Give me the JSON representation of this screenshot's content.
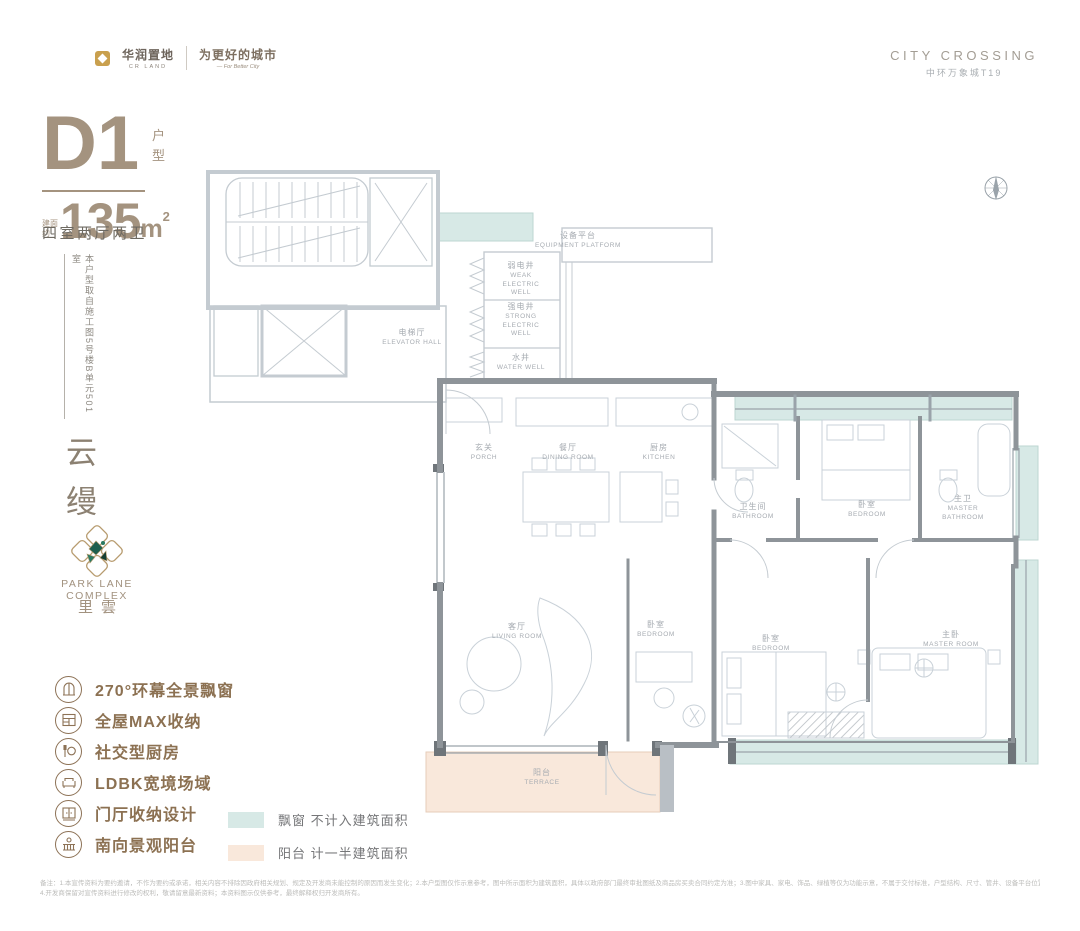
{
  "brand": {
    "logo_cn": "华润置地",
    "logo_en": "CR LAND",
    "tagline_cn": "为更好的城市",
    "tagline_en": "— For Better City"
  },
  "project": {
    "name_en": "CITY CROSSING",
    "name_cn": "中环万象城T19"
  },
  "unit": {
    "name": "D1",
    "name_suffix": "户型",
    "area_prefix": "建面约",
    "area_value": "135",
    "area_unit": "m",
    "area_sup": "2",
    "layout": "四室两厅两卫",
    "source_note": "本户型取自施工图5号楼B单元501室"
  },
  "branding_side": {
    "vertical_name": "云缦",
    "logo_caption_en": "PARK LANE COMPLEX",
    "logo_caption_cn": "里雲"
  },
  "features": [
    {
      "icon": "bay-window-icon",
      "label": "270°环幕全景飘窗"
    },
    {
      "icon": "storage-icon",
      "label": "全屋MAX收纳"
    },
    {
      "icon": "kitchen-icon",
      "label": "社交型厨房"
    },
    {
      "icon": "sofa-icon",
      "label": "LDBK宽境场域"
    },
    {
      "icon": "cabinet-icon",
      "label": "门厅收纳设计"
    },
    {
      "icon": "balcony-icon",
      "label": "南向景观阳台"
    }
  ],
  "legend": [
    {
      "swatch": "#d7e9e6",
      "label": "飘窗 不计入建筑面积"
    },
    {
      "swatch": "#f9e8db",
      "label": "阳台 计一半建筑面积"
    }
  ],
  "floorplan": {
    "rooms": [
      {
        "cn": "设备平台",
        "en": "EQUIPMENT PLATFORM"
      },
      {
        "cn": "弱电井",
        "en": "WEAK ELECTRIC WELL"
      },
      {
        "cn": "强电井",
        "en": "STRONG ELECTRIC WELL"
      },
      {
        "cn": "水井",
        "en": "WATER WELL"
      },
      {
        "cn": "电梯厅",
        "en": "ELEVATOR HALL"
      },
      {
        "cn": "玄关",
        "en": "PORCH"
      },
      {
        "cn": "餐厅",
        "en": "DINING ROOM"
      },
      {
        "cn": "厨房",
        "en": "KITCHEN"
      },
      {
        "cn": "卫生间",
        "en": "BATHROOM"
      },
      {
        "cn": "卧室",
        "en": "BEDROOM"
      },
      {
        "cn": "主卫",
        "en": "MASTER BATHROOM"
      },
      {
        "cn": "客厅",
        "en": "LIVING ROOM"
      },
      {
        "cn": "卧室",
        "en": "BEDROOM"
      },
      {
        "cn": "卧室",
        "en": "BEDROOM"
      },
      {
        "cn": "主卧",
        "en": "MASTER ROOM"
      },
      {
        "cn": "阳台",
        "en": "TERRACE"
      }
    ],
    "colors": {
      "bay_window_fill": "#d7e9e6",
      "terrace_fill": "#f9e8db",
      "wall": "#8e9499",
      "line_light": "#c4cbd1"
    }
  },
  "colors": {
    "accent_taupe": "#a4937f",
    "feature_brown": "#8c7152",
    "brand_gold": "#c9a04e",
    "emblem_green": "#1e5f4e"
  },
  "disclaimer": {
    "line1": "备注：1.本宣传资料为要约邀请，不作为要约或承诺，相关内容不排除因政府相关规划、规定及开发商未能控制的原因而发生变化；2.本户型图仅作示意参考，图中所示面积为建筑面积，具体以政府部门最终审批图纸及商品房买卖合同约定为准；3.图中家具、家电、饰品、绿植等仅为功能示意，不属于交付标准，户型结构、尺寸、管井、设备平台位置以实际交付为准。",
    "line2": "4.开发商保留对宣传资料进行修改的权利，敬请留意最新资料；本资料图示仅供参考，最终解释权归开发商所有。"
  }
}
